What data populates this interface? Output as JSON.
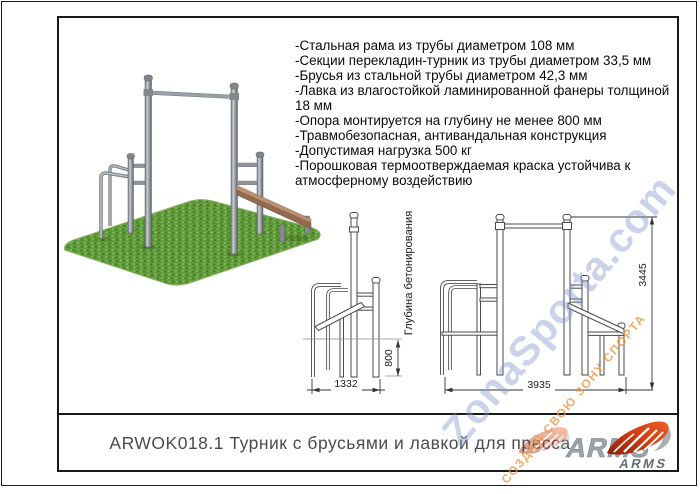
{
  "frame": {
    "title": "ARWOK018.1 Турник с брусьями и лавкой для пресса"
  },
  "specs": {
    "items": [
      "-Стальная рама из трубы диаметром 108 мм",
      "-Секции перекладин-турник из трубы диаметром 33,5 мм",
      "-Брусья из стальной трубы диаметром 42,3 мм",
      "-Лавка из влагостойкой ламинированной фанеры толщиной 18 мм",
      "-Опора монтируется на глубину не менее 800 мм",
      "-Травмобезопасная, антивандальная конструкция",
      "-Допустимая нагрузка 500 кг",
      "-Порошковая термоотверждаемая краска устойчива к атмосферному воздействию"
    ]
  },
  "drawings": {
    "side_view": {
      "width_dim": "1332",
      "depth_dim": "800",
      "depth_caption": "Глубина бетонирования"
    },
    "front_view": {
      "width_dim": "3935",
      "height_dim": "3445"
    }
  },
  "watermark": {
    "site": "ZonaSporta.com",
    "slogan": "СОЗДАЙ СВОЮ ЗОНУ СПОРТА"
  },
  "logo": {
    "brand_main": "ARMS",
    "brand_sub": "ARMS"
  },
  "colors": {
    "logo_red": "#d2421a",
    "logo_gray": "#9aa1a9",
    "watermark_blue": "#8096cd",
    "watermark_orange": "#e99642",
    "grass_green": "#619a3c",
    "bench_wood": "#b68e6e",
    "metal_gray": "#8f959b"
  }
}
